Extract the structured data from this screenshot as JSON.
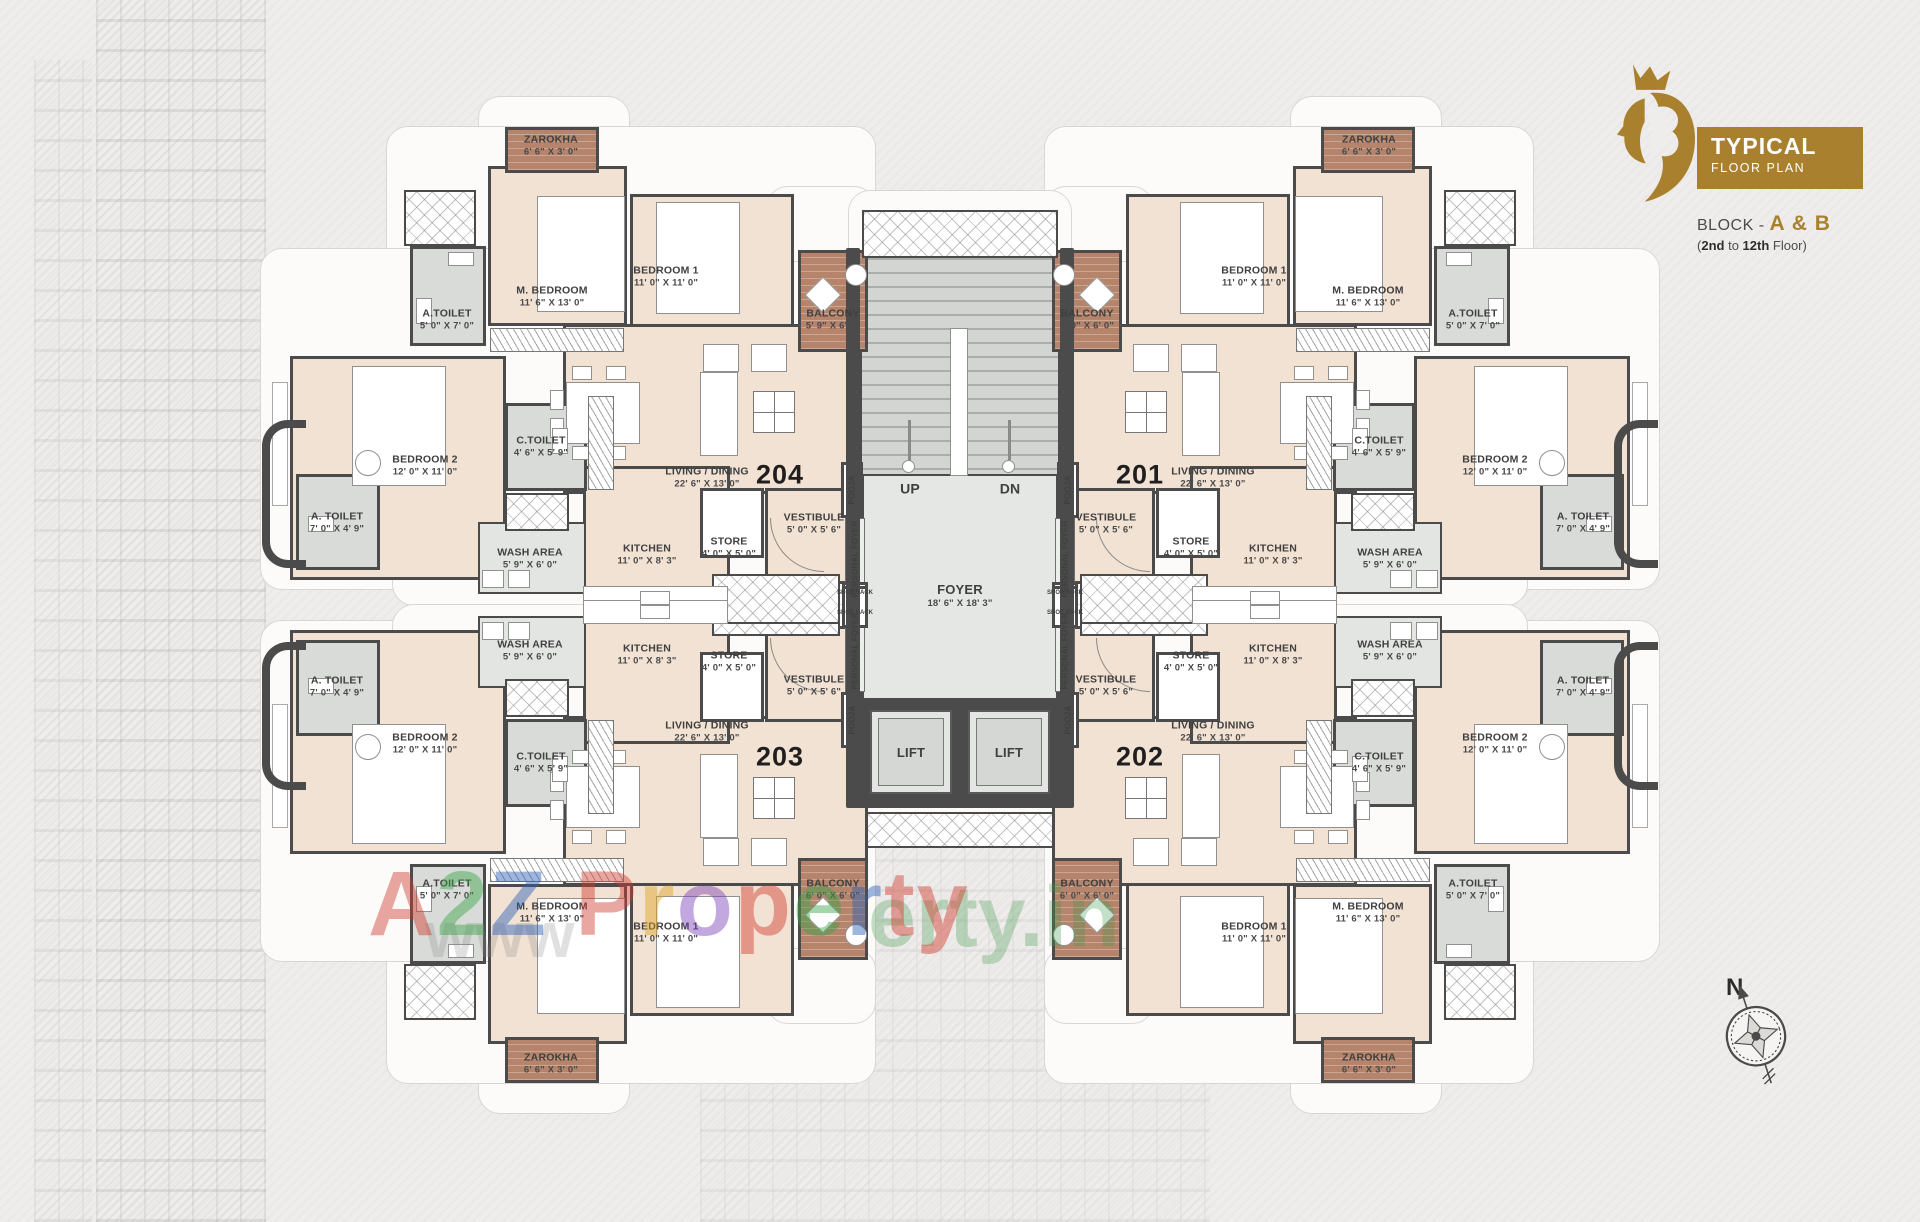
{
  "header": {
    "title1": "TYPICAL",
    "title2": "FLOOR PLAN",
    "block_prefix": "BLOCK - ",
    "block_value": "A & B",
    "floors": {
      "open": "(",
      "b1": "2nd",
      "mid": " to ",
      "b2": "12th",
      "tail": " Floor)"
    },
    "brand_color": "#a9812e"
  },
  "compass": {
    "label": "N"
  },
  "watermark": {
    "text": "A2Z Property",
    "letter_colors": [
      "#d23b2f",
      "#3aa547",
      "#2b5fb8",
      "#2b5fb8",
      "#d23b2f",
      "#e0a420",
      "#7a3fb8",
      "#d23b2f",
      "#3aa547",
      "#2b5fb8",
      "#d23b2f"
    ],
    "www": "www",
    "tail": "erty.in"
  },
  "core": {
    "up": {
      "text": "UP",
      "x": 910,
      "y": 489
    },
    "dn": {
      "text": "DN",
      "x": 1010,
      "y": 489
    },
    "foyer": {
      "name": "FOYER",
      "dims": "18' 6\" X 18' 3\"",
      "x": 960,
      "y": 596
    },
    "lifts": [
      {
        "text": "LIFT",
        "x": 911,
        "y": 753
      },
      {
        "text": "LIFT",
        "x": 1009,
        "y": 753
      }
    ],
    "pooja": {
      "text": "POOJA",
      "pos": [
        [
          852,
          490
        ],
        [
          1068,
          490
        ],
        [
          852,
          720
        ],
        [
          1068,
          720
        ]
      ]
    },
    "personal_foyer": {
      "text": "PERSONAL FOYER",
      "pos": [
        [
          855,
          559
        ],
        [
          1065,
          559
        ],
        [
          855,
          651
        ],
        [
          1065,
          651
        ]
      ]
    },
    "shoe_rack": {
      "text": "SHOE RACK",
      "pos": [
        [
          855,
          593
        ],
        [
          855,
          613
        ],
        [
          1065,
          593
        ],
        [
          1065,
          613
        ]
      ]
    }
  },
  "units": [
    {
      "number": "204",
      "nx": 780,
      "ny": 475,
      "rooms": [
        {
          "name": "ZAROKHA",
          "dims": "6' 6\" X 3' 0\"",
          "x": 551,
          "y": 146
        },
        {
          "name": "M. BEDROOM",
          "dims": "11' 6\" X 13' 0\"",
          "x": 552,
          "y": 297
        },
        {
          "name": "BEDROOM 1",
          "dims": "11' 0\" X 11' 0\"",
          "x": 666,
          "y": 277
        },
        {
          "name": "BALCONY",
          "dims": "5' 9\" X 6' 0\"",
          "x": 833,
          "y": 320
        },
        {
          "name": "A.TOILET",
          "dims": "5' 0\" X 7' 0\"",
          "x": 447,
          "y": 320
        },
        {
          "name": "BEDROOM 2",
          "dims": "12' 0\" X 11' 0\"",
          "x": 425,
          "y": 466
        },
        {
          "name": "A. TOILET",
          "dims": "7' 0\" X 4' 9\"",
          "x": 337,
          "y": 523,
          "narrow": true
        },
        {
          "name": "C.TOILET",
          "dims": "4' 6\" X 5' 9\"",
          "x": 541,
          "y": 447
        },
        {
          "name": "LIVING / DINING",
          "dims": "22' 6\" X 13' 0\"",
          "x": 707,
          "y": 478
        },
        {
          "name": "KITCHEN",
          "dims": "11' 0\" X 8' 3\"",
          "x": 647,
          "y": 555
        },
        {
          "name": "STORE",
          "dims": "4' 0\" X 5' 0\"",
          "x": 729,
          "y": 548
        },
        {
          "name": "WASH AREA",
          "dims": "5' 9\" X 6' 0\"",
          "x": 530,
          "y": 559
        },
        {
          "name": "VESTIBULE",
          "dims": "5' 0\" X 5' 6\"",
          "x": 814,
          "y": 524
        }
      ]
    },
    {
      "number": "201",
      "nx": 1140,
      "ny": 475,
      "rooms": [
        {
          "name": "ZAROKHA",
          "dims": "6' 6\" X 3' 0\"",
          "x": 1369,
          "y": 146
        },
        {
          "name": "M. BEDROOM",
          "dims": "11' 6\" X 13' 0\"",
          "x": 1368,
          "y": 297
        },
        {
          "name": "BEDROOM 1",
          "dims": "11' 0\" X 11' 0\"",
          "x": 1254,
          "y": 277
        },
        {
          "name": "BALCONY",
          "dims": "5' 9\" X 6' 0\"",
          "x": 1087,
          "y": 320
        },
        {
          "name": "A.TOILET",
          "dims": "5' 0\" X 7' 0\"",
          "x": 1473,
          "y": 320
        },
        {
          "name": "BEDROOM 2",
          "dims": "12' 0\" X 11' 0\"",
          "x": 1495,
          "y": 466
        },
        {
          "name": "A. TOILET",
          "dims": "7' 0\" X 4' 9\"",
          "x": 1583,
          "y": 523,
          "narrow": true
        },
        {
          "name": "C.TOILET",
          "dims": "4' 6\" X 5' 9\"",
          "x": 1379,
          "y": 447
        },
        {
          "name": "LIVING / DINING",
          "dims": "22' 6\" X 13' 0\"",
          "x": 1213,
          "y": 478
        },
        {
          "name": "KITCHEN",
          "dims": "11' 0\" X 8' 3\"",
          "x": 1273,
          "y": 555
        },
        {
          "name": "STORE",
          "dims": "4' 0\" X 5' 0\"",
          "x": 1191,
          "y": 548
        },
        {
          "name": "WASH AREA",
          "dims": "5' 9\" X 6' 0\"",
          "x": 1390,
          "y": 559
        },
        {
          "name": "VESTIBULE",
          "dims": "5' 0\" X 5' 6\"",
          "x": 1106,
          "y": 524
        }
      ]
    },
    {
      "number": "203",
      "nx": 780,
      "ny": 757,
      "rooms": [
        {
          "name": "ZAROKHA",
          "dims": "6' 6\" X 3' 0\"",
          "x": 551,
          "y": 1064
        },
        {
          "name": "M. BEDROOM",
          "dims": "11' 6\" X 13' 0\"",
          "x": 552,
          "y": 913
        },
        {
          "name": "BEDROOM 1",
          "dims": "11' 0\" X 11' 0\"",
          "x": 666,
          "y": 933
        },
        {
          "name": "BALCONY",
          "dims": "6' 0\" X 6' 0\"",
          "x": 833,
          "y": 890
        },
        {
          "name": "A.TOILET",
          "dims": "5' 0\" X 7' 0\"",
          "x": 447,
          "y": 890
        },
        {
          "name": "BEDROOM 2",
          "dims": "12' 0\" X 11' 0\"",
          "x": 425,
          "y": 744
        },
        {
          "name": "A. TOILET",
          "dims": "7' 0\" X 4' 9\"",
          "x": 337,
          "y": 687,
          "narrow": true
        },
        {
          "name": "C.TOILET",
          "dims": "4' 6\" X 5' 9\"",
          "x": 541,
          "y": 763
        },
        {
          "name": "LIVING / DINING",
          "dims": "22' 6\" X 13' 0\"",
          "x": 707,
          "y": 732
        },
        {
          "name": "KITCHEN",
          "dims": "11' 0\" X 8' 3\"",
          "x": 647,
          "y": 655
        },
        {
          "name": "STORE",
          "dims": "4' 0\" X 5' 0\"",
          "x": 729,
          "y": 662
        },
        {
          "name": "WASH AREA",
          "dims": "5' 9\" X 6' 0\"",
          "x": 530,
          "y": 651
        },
        {
          "name": "VESTIBULE",
          "dims": "5' 0\" X 5' 6\"",
          "x": 814,
          "y": 686
        }
      ]
    },
    {
      "number": "202",
      "nx": 1140,
      "ny": 757,
      "rooms": [
        {
          "name": "ZAROKHA",
          "dims": "6' 6\" X 3' 0\"",
          "x": 1369,
          "y": 1064
        },
        {
          "name": "M. BEDROOM",
          "dims": "11' 6\" X 13' 0\"",
          "x": 1368,
          "y": 913
        },
        {
          "name": "BEDROOM 1",
          "dims": "11' 0\" X 11' 0\"",
          "x": 1254,
          "y": 933
        },
        {
          "name": "BALCONY",
          "dims": "6' 0\" X 6' 0\"",
          "x": 1087,
          "y": 890
        },
        {
          "name": "A.TOILET",
          "dims": "5' 0\" X 7' 0\"",
          "x": 1473,
          "y": 890
        },
        {
          "name": "BEDROOM 2",
          "dims": "12' 0\" X 11' 0\"",
          "x": 1495,
          "y": 744
        },
        {
          "name": "A. TOILET",
          "dims": "7' 0\" X 4' 9\"",
          "x": 1583,
          "y": 687,
          "narrow": true
        },
        {
          "name": "C.TOILET",
          "dims": "4' 6\" X 5' 9\"",
          "x": 1379,
          "y": 763
        },
        {
          "name": "LIVING / DINING",
          "dims": "22' 6\" X 13' 0\"",
          "x": 1213,
          "y": 732
        },
        {
          "name": "KITCHEN",
          "dims": "11' 0\" X 8' 3\"",
          "x": 1273,
          "y": 655
        },
        {
          "name": "STORE",
          "dims": "4' 0\" X 5' 0\"",
          "x": 1191,
          "y": 662
        },
        {
          "name": "WASH AREA",
          "dims": "5' 9\" X 6' 0\"",
          "x": 1390,
          "y": 651
        },
        {
          "name": "VESTIBULE",
          "dims": "5' 0\" X 5' 6\"",
          "x": 1106,
          "y": 686
        }
      ]
    }
  ]
}
